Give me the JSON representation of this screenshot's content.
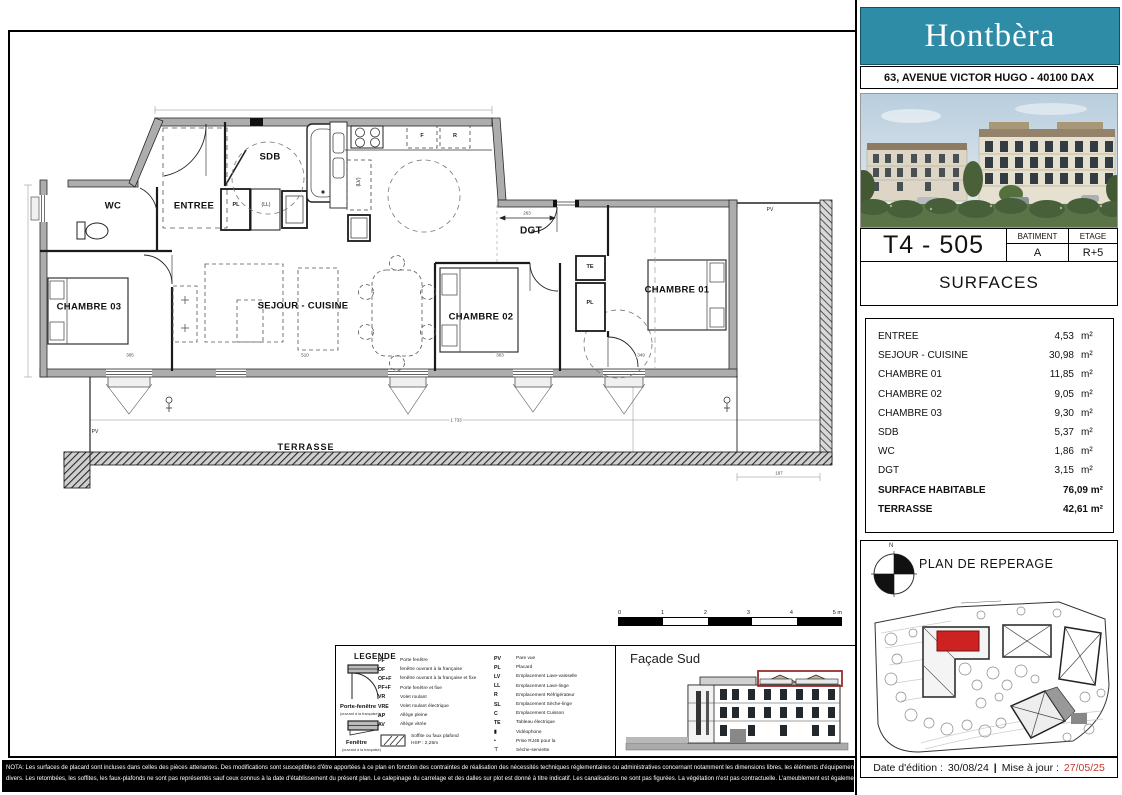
{
  "header": {
    "brand": "Hontbèra",
    "address": "63, AVENUE VICTOR HUGO - 40100 DAX"
  },
  "unit": {
    "code": "T4 - 505",
    "batiment_label": "BATIMENT",
    "batiment_value": "A",
    "etage_label": "ETAGE",
    "etage_value": "R+5",
    "surfaces_title": "SURFACES"
  },
  "surfaces": {
    "rows": [
      {
        "label": "ENTREE",
        "value": "4,53",
        "unit": "m²"
      },
      {
        "label": "SEJOUR - CUISINE",
        "value": "30,98",
        "unit": "m²"
      },
      {
        "label": "CHAMBRE 01",
        "value": "11,85",
        "unit": "m²"
      },
      {
        "label": "CHAMBRE 02",
        "value": "9,05",
        "unit": "m²"
      },
      {
        "label": "CHAMBRE 03",
        "value": "9,30",
        "unit": "m²"
      },
      {
        "label": "SDB",
        "value": "5,37",
        "unit": "m²"
      },
      {
        "label": "WC",
        "value": "1,86",
        "unit": "m²"
      },
      {
        "label": "DGT",
        "value": "3,15",
        "unit": "m²"
      }
    ],
    "totals": [
      {
        "label": "SURFACE HABITABLE",
        "value": "76,09 m²"
      },
      {
        "label": "TERRASSE",
        "value": "42,61 m²"
      }
    ]
  },
  "plan": {
    "rooms": {
      "wc": "WC",
      "entree": "ENTREE",
      "sdb": "SDB",
      "sejour": "SEJOUR - CUISINE",
      "chambre01": "CHAMBRE 01",
      "chambre02": "CHAMBRE 02",
      "chambre03": "CHAMBRE 03",
      "dgt": "DGT",
      "terrasse": "TERRASSE"
    },
    "tags": {
      "pl1": "PL",
      "ll": "(LL)",
      "lv": "(LV)",
      "f": "F",
      "r": "R",
      "te": "TE",
      "pl2": "PL",
      "pv_right": "PV",
      "pv_left": "PV"
    },
    "dims": {
      "d263": "263",
      "d1733": "1 733",
      "d305": "305",
      "d510": "510",
      "d303": "303",
      "d349": "349",
      "d197": "197"
    }
  },
  "scalebar": {
    "ticks": [
      {
        "t": "0"
      },
      {
        "t": "1"
      },
      {
        "t": "2"
      },
      {
        "t": "3"
      },
      {
        "t": "4"
      },
      {
        "t": "5 m"
      }
    ]
  },
  "legend": {
    "title": "LEGENDE",
    "pf_label": "Porte-fenêtre",
    "pf_sub": "(ouvrant à la française)",
    "f_label": "Fenêtre",
    "f_sub": "(ouvrant à la française)",
    "col1": [
      {
        "abbr": "PF",
        "label": "Porte fenêtre"
      },
      {
        "abbr": "OF",
        "label": "fenêtre ouvrant à la française"
      },
      {
        "abbr": "OF+F",
        "label": "fenêtre ouvrant à la française et fixe"
      },
      {
        "abbr": "PF+F",
        "label": "Porte fenêtre et fixe"
      },
      {
        "abbr": "VR",
        "label": "Volet roulant"
      },
      {
        "abbr": "VRE",
        "label": "Volet roulant électrique"
      },
      {
        "abbr": "AP",
        "label": "Allège pleine"
      },
      {
        "abbr": "AV",
        "label": "Allège vitrée"
      }
    ],
    "soffite_label": "Soffite ou faux plafond",
    "soffite_sub": "HSP : 2,25m",
    "col2": [
      {
        "abbr": "PV",
        "label": "Pare vue"
      },
      {
        "abbr": "PL",
        "label": "Placard"
      },
      {
        "abbr": "LV",
        "label": "Emplacement Lave-vaisselle"
      },
      {
        "abbr": "LL",
        "label": "Emplacement Lave-linge"
      },
      {
        "abbr": "R",
        "label": "Emplacement Réfrigérateur"
      },
      {
        "abbr": "SL",
        "label": "Emplacement Sèche-linge"
      },
      {
        "abbr": "C",
        "label": "Emplacement Cuisson"
      },
      {
        "abbr": "TE",
        "label": "Tableau électrique"
      },
      {
        "abbr": "▮",
        "label": "Vidéophone"
      },
      {
        "abbr": "▪",
        "label": "Prise RJ45 pour la"
      },
      {
        "abbr": "⊤",
        "label": "Sèche-serviette"
      }
    ]
  },
  "facade": {
    "title": "Façade Sud"
  },
  "reperage": {
    "title": "PLAN DE REPERAGE",
    "north": "N"
  },
  "footer": {
    "nota_line1": "NOTA: Les surfaces de placard sont incluses dans celles des pièces attenantes. Des modifications sont susceptibles d'être apportées à ce plan en fonction des contraintes de réalisation des nécessités techniques réglementaires ou administratives concernant notamment les dimensions libres, les éléments d'équipements et les réseaux",
    "nota_line2": "divers. Les retombées, les soffites, les faux-plafonds ne sont pas représentés sauf ceux connus à la date d'établissement du présent plan. Le calepinage du carrelage et des dalles sur plot est donné à titre indicatif. Les canalisations ne sont pas figurées. La végétation n'est pas contractuelle. L'ameublement est également indicatif.",
    "edition_label": "Date d'édition :",
    "edition_date": "30/08/24",
    "separator": "|",
    "update_label": "Mise à jour :",
    "update_date": "27/05/25"
  },
  "colors": {
    "teal": "#2e8ca6",
    "date_red": "#c0392b",
    "unit_red": "#cc2222",
    "wall_gray": "#adadad"
  }
}
